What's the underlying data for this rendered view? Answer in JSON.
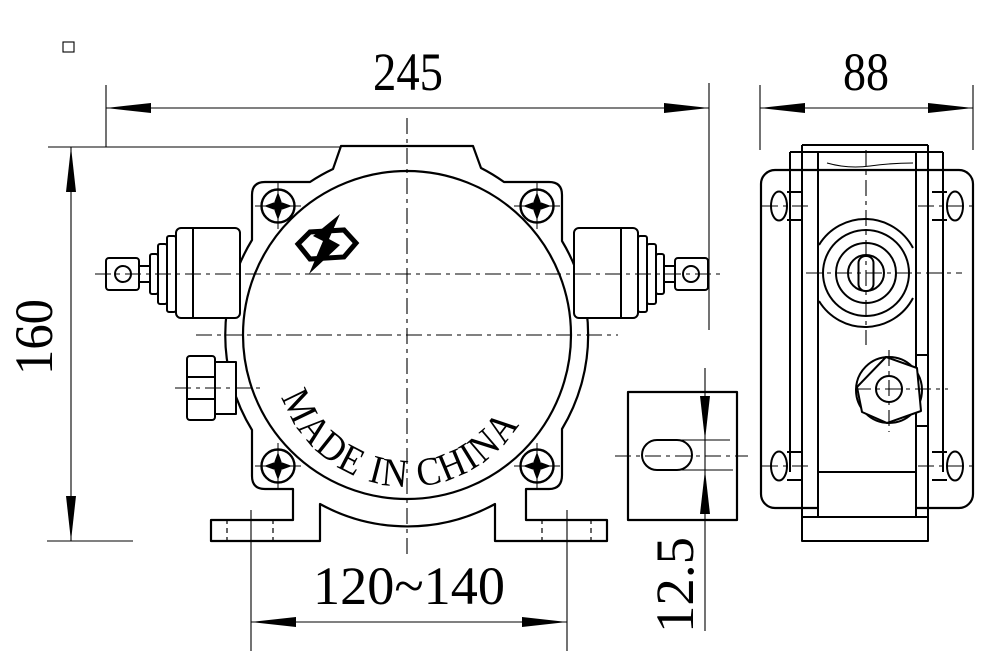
{
  "drawing": {
    "type": "engineering-drawing",
    "subject": "explosion-proof pull-cord switch, front view / side view / foot slot detail",
    "colors": {
      "background": "#ffffff",
      "line": "#000000"
    },
    "label": {
      "made_in": "MADE IN CHINA"
    },
    "dimensions": {
      "front_width": "245",
      "side_depth": "88",
      "height": "160",
      "foot_span": "120~140",
      "slot_width": "12.5"
    },
    "icons": {
      "logo": "explosion-proof-lightning-hexagon",
      "screw": "phillips-screw"
    }
  }
}
